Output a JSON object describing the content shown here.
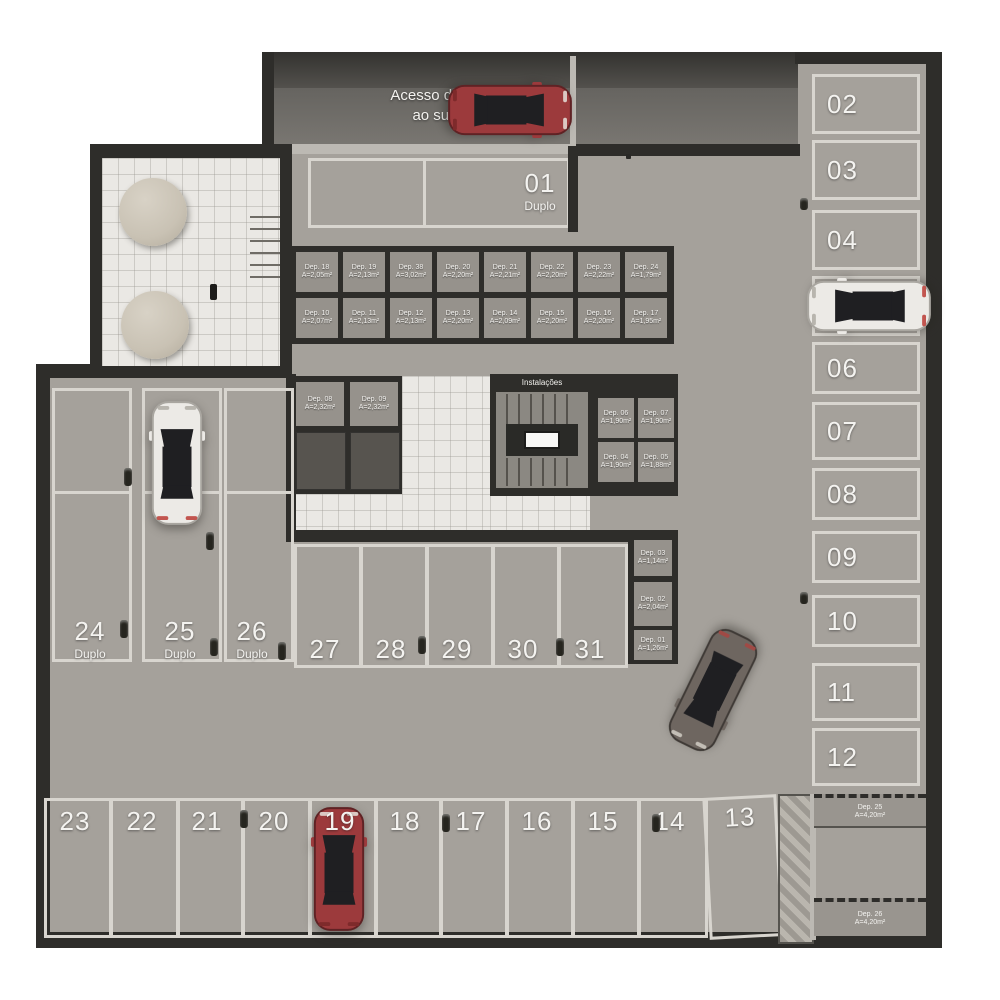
{
  "ramp": {
    "line1": "Acesso de veículos",
    "line2": "ao subsolo 2"
  },
  "labels": {
    "instalacoes": "Instalações"
  },
  "spaces": {
    "s01": {
      "num": "01",
      "type": "Duplo"
    },
    "right_col": [
      "02",
      "03",
      "04",
      "05",
      "06",
      "07",
      "08",
      "09",
      "10",
      "11",
      "12"
    ],
    "tandem": [
      {
        "num": "24",
        "type": "Duplo"
      },
      {
        "num": "25",
        "type": "Duplo"
      },
      {
        "num": "26",
        "type": "Duplo"
      }
    ],
    "mid_row": [
      "27",
      "28",
      "29",
      "30",
      "31"
    ],
    "bottom_row": [
      "23",
      "22",
      "21",
      "20",
      "19",
      "18",
      "17",
      "16",
      "15",
      "14",
      "13"
    ]
  },
  "deposits": {
    "top": [
      {
        "n": "Dep. 18",
        "a": "A=2,05m²"
      },
      {
        "n": "Dep. 19",
        "a": "A=2,13m²"
      },
      {
        "n": "Dep. 38",
        "a": "A=3,02m²"
      },
      {
        "n": "Dep. 20",
        "a": "A=2,20m²"
      },
      {
        "n": "Dep. 21",
        "a": "A=2,21m²"
      },
      {
        "n": "Dep. 22",
        "a": "A=2,20m²"
      },
      {
        "n": "Dep. 23",
        "a": "A=2,22m²"
      },
      {
        "n": "Dep. 24",
        "a": "A=1,79m²"
      }
    ],
    "bottom": [
      {
        "n": "Dep. 10",
        "a": "A=2,07m²"
      },
      {
        "n": "Dep. 11",
        "a": "A=2,13m²"
      },
      {
        "n": "Dep. 12",
        "a": "A=2,13m²"
      },
      {
        "n": "Dep. 13",
        "a": "A=2,20m²"
      },
      {
        "n": "Dep. 14",
        "a": "A=2,09m²"
      },
      {
        "n": "Dep. 15",
        "a": "A=2,20m²"
      },
      {
        "n": "Dep. 16",
        "a": "A=2,20m²"
      },
      {
        "n": "Dep. 17",
        "a": "A=1,95m²"
      }
    ],
    "core": {
      "d08": {
        "n": "Dep. 08",
        "a": "A=2,32m²"
      },
      "d09": {
        "n": "Dep. 09",
        "a": "A=2,32m²"
      },
      "d06": {
        "n": "Dep. 06",
        "a": "A=1,90m²"
      },
      "d07": {
        "n": "Dep. 07",
        "a": "A=1,90m²"
      },
      "d04": {
        "n": "Dep. 04",
        "a": "A=1,90m²"
      },
      "d05": {
        "n": "Dep. 05",
        "a": "A=1,88m²"
      }
    },
    "col": [
      {
        "n": "Dep. 03",
        "a": "A=1,14m²"
      },
      {
        "n": "Dep. 02",
        "a": "A=2,04m²"
      },
      {
        "n": "Dep. 01",
        "a": "A=1,26m²"
      }
    ],
    "d25": {
      "n": "Dep. 25",
      "a": "A=4,20m²"
    },
    "d26": {
      "n": "Dep. 26",
      "a": "A=4,20m²"
    }
  },
  "colors": {
    "wall": "#2e2d2a",
    "floor": "#a5a19b",
    "curb": "#bcb9b3",
    "stall": "#d8d5cf",
    "tile": "#eae8e4",
    "depCell": "#96928c",
    "depDark": "#57544f",
    "text": "#f4f3f0",
    "ramp": "#7b7873",
    "rampTop": "#393835",
    "hatchA": "#9d9992",
    "hatchB": "#bab6ae",
    "carRed": "#9c3a3c",
    "carWhite": "#eceae6",
    "carGray": "#6e6660",
    "glass": "#1f1f22"
  }
}
